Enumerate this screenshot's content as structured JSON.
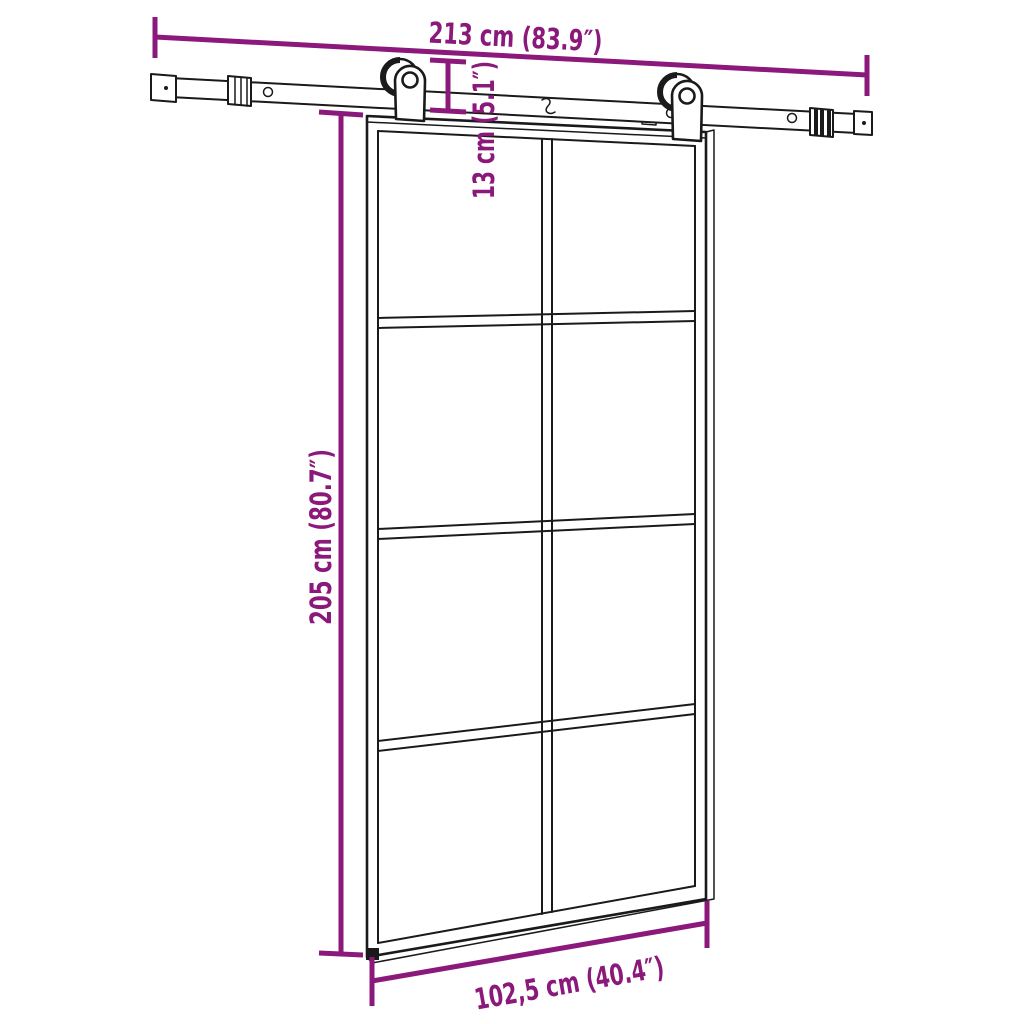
{
  "colors": {
    "accent": "#8B187B",
    "ink": "#1A1A1A",
    "background": "#FFFFFF"
  },
  "diagram": {
    "kind": "product-dimension-line-drawing",
    "subject": "sliding glass door with sliding rail hardware kit",
    "door": {
      "pane_rows": 4,
      "pane_columns": 2,
      "pane_count": 8
    },
    "hardware": {
      "rollers": 2,
      "rail_segments": 3
    },
    "dimensions": [
      {
        "id": "rail-width",
        "cm": "213",
        "inch": "83.9",
        "label": "213 cm (83.9″)",
        "orientation": "horizontal"
      },
      {
        "id": "hanger-drop",
        "cm": "13",
        "inch": "5.1",
        "label": "13 cm (5.1″)",
        "orientation": "vertical"
      },
      {
        "id": "door-height",
        "cm": "205",
        "inch": "80.7",
        "label": "205 cm (80.7″)",
        "orientation": "vertical"
      },
      {
        "id": "door-width",
        "cm": "102,5",
        "inch": "40.4",
        "label": "102,5 cm (40.4″)",
        "orientation": "horizontal"
      }
    ]
  }
}
